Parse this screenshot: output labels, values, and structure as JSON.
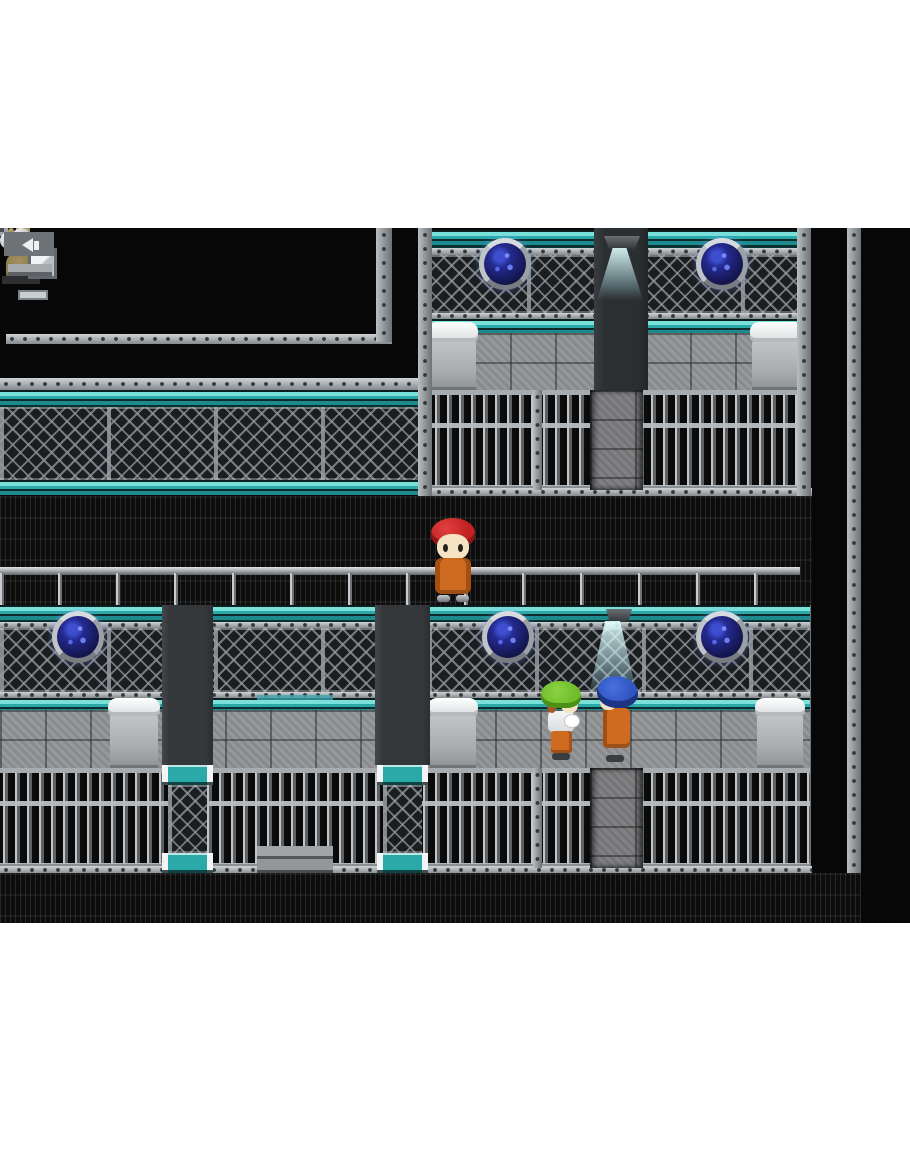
{
  "app": {
    "type": "game-screenshot",
    "style": "rpg-maker-2d-tilemap",
    "scene_name": "prison-cell-block-interior",
    "visible_text": "none"
  },
  "palette": {
    "bg_black": "#070707",
    "letterbox": "#ffffff",
    "teal_bright": "#79e0da",
    "teal_dark": "#1f8a8e",
    "stone_gray": "#909294",
    "porthole_blue": "#3d4fd0",
    "porthole_navy": "#14164f",
    "orange_suit": "#ce6b20",
    "orange_shadow": "#a34f12",
    "red_hair": "#c32222",
    "green_hair": "#6fbe2a",
    "blue_hair": "#2f55c0",
    "skin": "#f6e3c4",
    "bronze": "#8d7a4f"
  },
  "scene": {
    "characters": [
      {
        "id": "prisoner-red",
        "desc": "red-haired prisoner in orange jumpsuit facing camera on upper walkway",
        "box": {
          "x": 428,
          "y": 290,
          "w": 50,
          "h": 84
        }
      },
      {
        "id": "prisoner-green-cap",
        "desc": "prisoner with green cap holding white bundle, facing right",
        "box": {
          "x": 541,
          "y": 453,
          "w": 42,
          "h": 79
        }
      },
      {
        "id": "prisoner-blue",
        "desc": "blue-haired prisoner in orange jumpsuit facing left",
        "box": {
          "x": 596,
          "y": 448,
          "w": 42,
          "h": 86
        }
      }
    ],
    "portholes": [
      {
        "x": 479,
        "y": 10,
        "w": 52,
        "h": 52
      },
      {
        "x": 696,
        "y": 10,
        "w": 52,
        "h": 52
      },
      {
        "x": 52,
        "y": 383,
        "w": 52,
        "h": 52
      },
      {
        "x": 482,
        "y": 383,
        "w": 52,
        "h": 52
      },
      {
        "x": 696,
        "y": 383,
        "w": 52,
        "h": 52
      }
    ],
    "lamps": [
      {
        "x": 604,
        "y": 8,
        "w": 36,
        "h": 13
      },
      {
        "x": 606,
        "y": 381,
        "w": 26,
        "h": 13
      }
    ],
    "beams": [
      {
        "x": 597,
        "y": 20,
        "w": 46,
        "h": 52
      },
      {
        "x": 588,
        "y": 393,
        "w": 50,
        "h": 78
      }
    ],
    "objects": {
      "door": {
        "box": {
          "x": 45,
          "y": 174,
          "w": 63,
          "h": 93
        }
      },
      "camera_fixture": {
        "box": {
          "x": 282,
          "y": 168,
          "w": 34,
          "h": 22
        }
      },
      "hand_statue": {
        "box": {
          "x": 599,
          "y": 52,
          "w": 44,
          "h": 56
        }
      },
      "stairs": {
        "box": {
          "x": 253,
          "y": 377,
          "w": 84,
          "h": 268
        }
      },
      "sink_unit": {
        "box": {
          "x": 643,
          "y": 484,
          "w": 56,
          "h": 54
        }
      },
      "beds": [
        {
          "x": 428,
          "y": 94,
          "w": 50,
          "h": 68
        },
        {
          "x": 750,
          "y": 94,
          "w": 52,
          "h": 68
        },
        {
          "x": 108,
          "y": 470,
          "w": 52,
          "h": 70
        },
        {
          "x": 428,
          "y": 470,
          "w": 50,
          "h": 70
        },
        {
          "x": 755,
          "y": 470,
          "w": 50,
          "h": 70
        }
      ]
    }
  }
}
